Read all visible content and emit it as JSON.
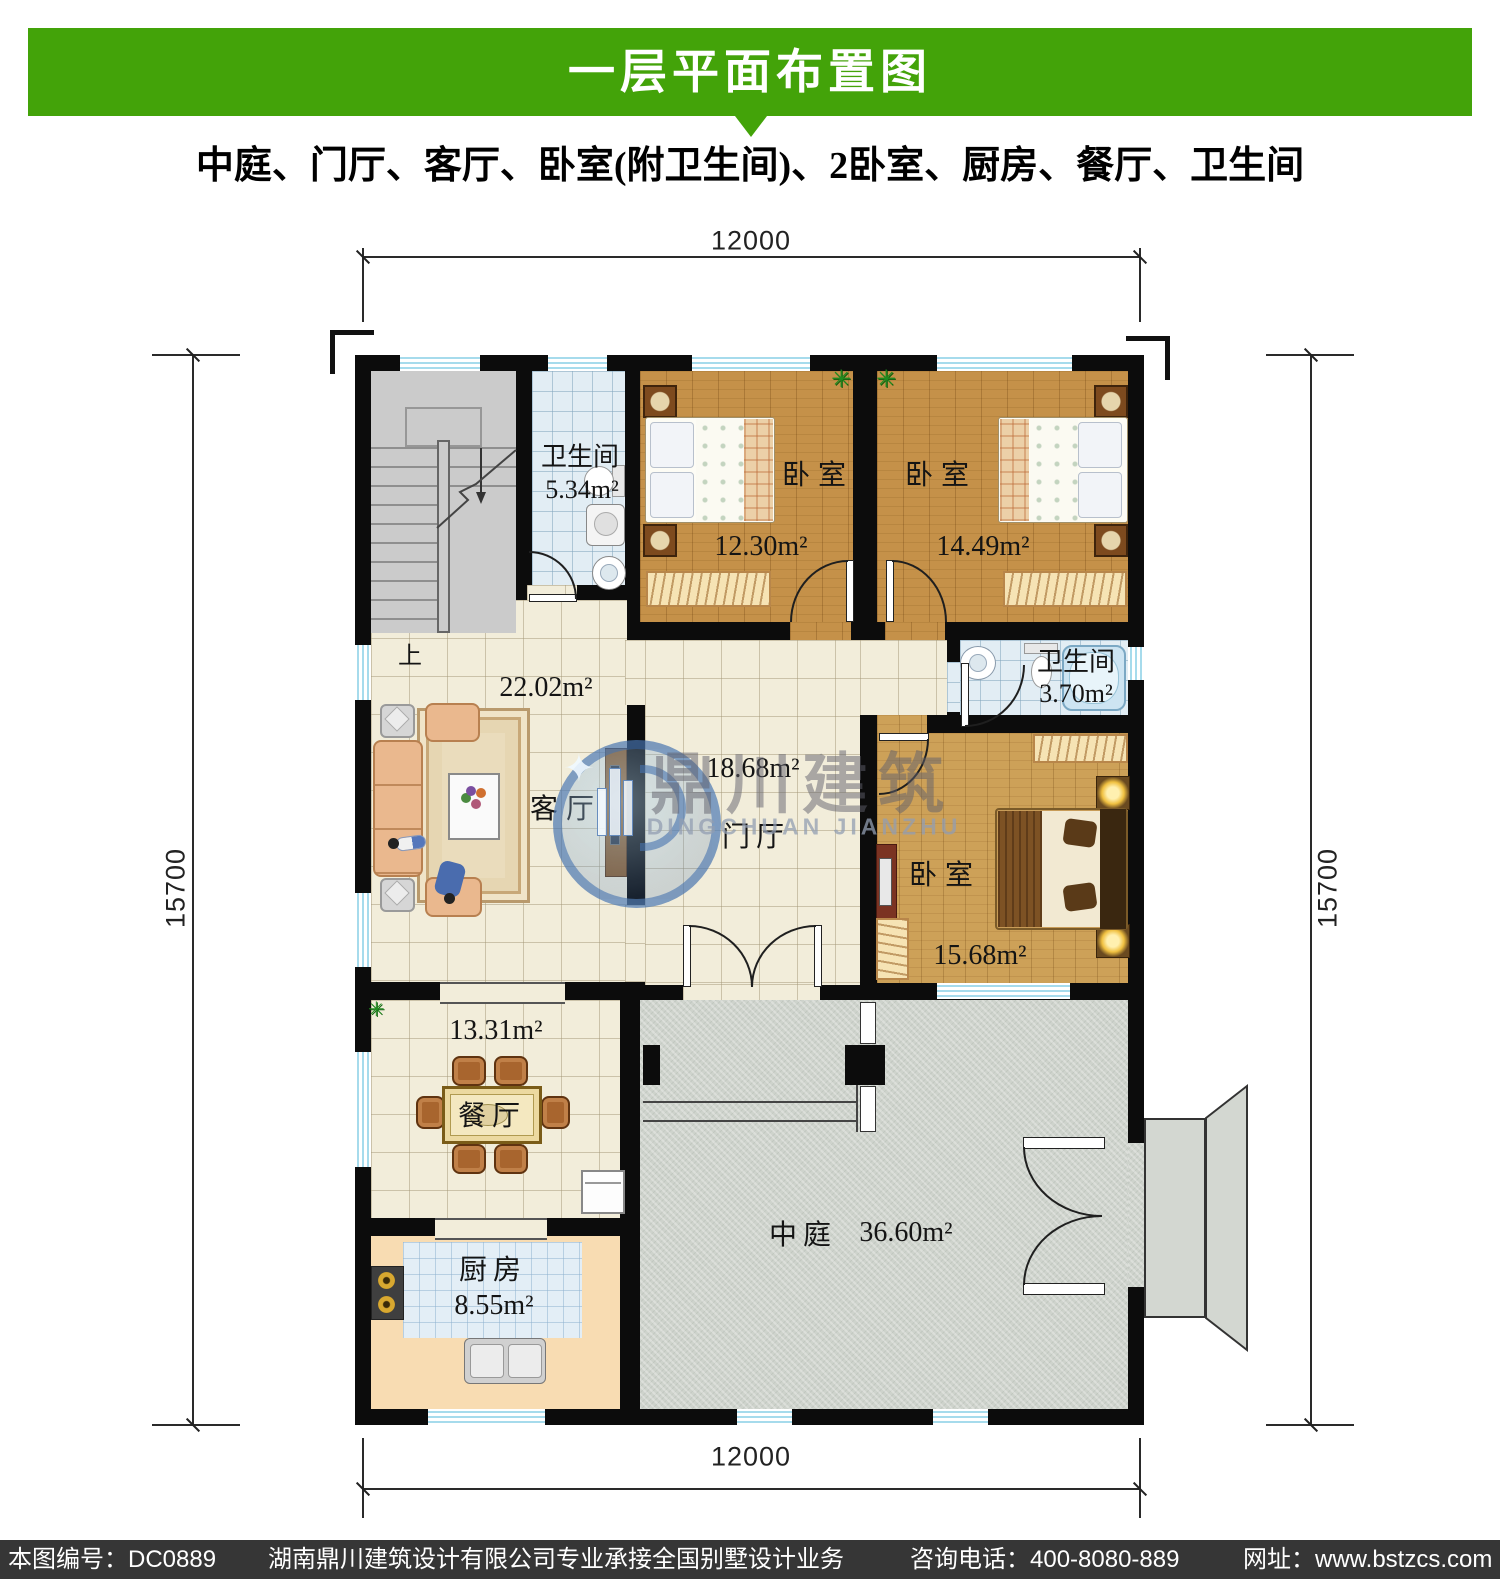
{
  "header": {
    "title": "一层平面布置图"
  },
  "subtitle": "中庭、门厅、客厅、卧室(附卫生间)、2卧室、厨房、餐厅、卫生间",
  "dimensions": {
    "top": "12000",
    "bottom": "12000",
    "left": "15700",
    "right": "15700"
  },
  "rooms": {
    "stairs": {
      "direction_label": "上"
    },
    "bath_top": {
      "name": "卫生间",
      "area": "5.34m²"
    },
    "bedroom_left": {
      "name": "卧室",
      "area": "12.30m²"
    },
    "bedroom_right": {
      "name": "卧室",
      "area": "14.49m²"
    },
    "living": {
      "name": "客厅",
      "area": "22.02m²"
    },
    "foyer": {
      "name": "门厅",
      "area": "18.68m²"
    },
    "bath_right": {
      "name": "卫生间",
      "area": "3.70m²"
    },
    "bedroom_master": {
      "name": "卧室",
      "area": "15.68m²"
    },
    "dining": {
      "name": "餐厅",
      "area": "13.31m²"
    },
    "kitchen": {
      "name": "厨房",
      "area": "8.55m²"
    },
    "courtyard": {
      "name": "中庭",
      "area": "36.60m²"
    }
  },
  "watermark": {
    "logo_cn": "鼎川建筑",
    "logo_en": "DINGCHUAN JIANZHU"
  },
  "footer": {
    "drawing_no": "本图编号：DC0889",
    "company": "湖南鼎川建筑设计有限公司专业承接全国别墅设计业务",
    "phone": "咨询电话：400-8080-889",
    "website": "网址：www.bstzcs.com"
  },
  "colors": {
    "accent_green": "#43a309",
    "wall_black": "#0c0c0c",
    "footer_bg": "#363636",
    "window_blue": "#a6dbec",
    "tile_beige": "#f2edda",
    "wood_brown": "#c59149",
    "bath_blue": "#e2edf4",
    "courtyard_gray": "#ced3cc"
  }
}
